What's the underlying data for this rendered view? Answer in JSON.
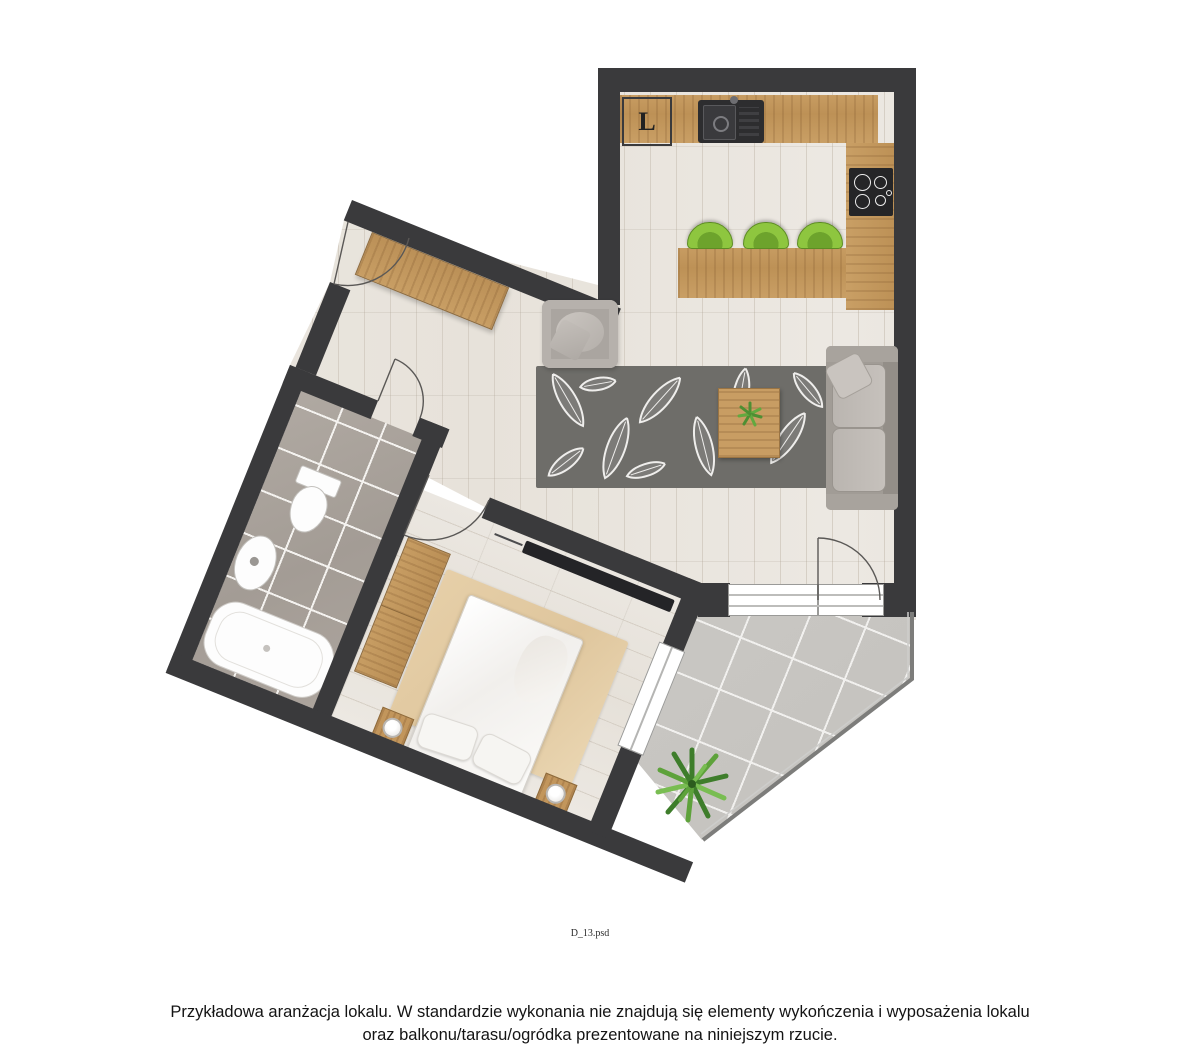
{
  "floor_plan": {
    "fridge_label": "L",
    "file_label": "D_13.psd"
  },
  "footer": {
    "line1": "Przykładowa aranżacja lokalu. W standardzie wykonania nie znajdują się elementy wykończenia i wyposażenia lokalu",
    "line2": "oraz balkonu/tarasu/ogródka prezentowane na niniejszym rzucie."
  },
  "colors": {
    "wall": "#3a3a3c",
    "wood": "#c59a5f",
    "floor": "#eae6e0",
    "bathroom_tile": "#aaa39c",
    "balcony_tile": "#c6c4c0",
    "stool_green": "#8ec63f",
    "sofa_gray": "#b3aeaa",
    "rug_dark": "#6e6d69",
    "bedroom_rug": "#e6cfa8",
    "plant_green": "#4e8f33"
  }
}
